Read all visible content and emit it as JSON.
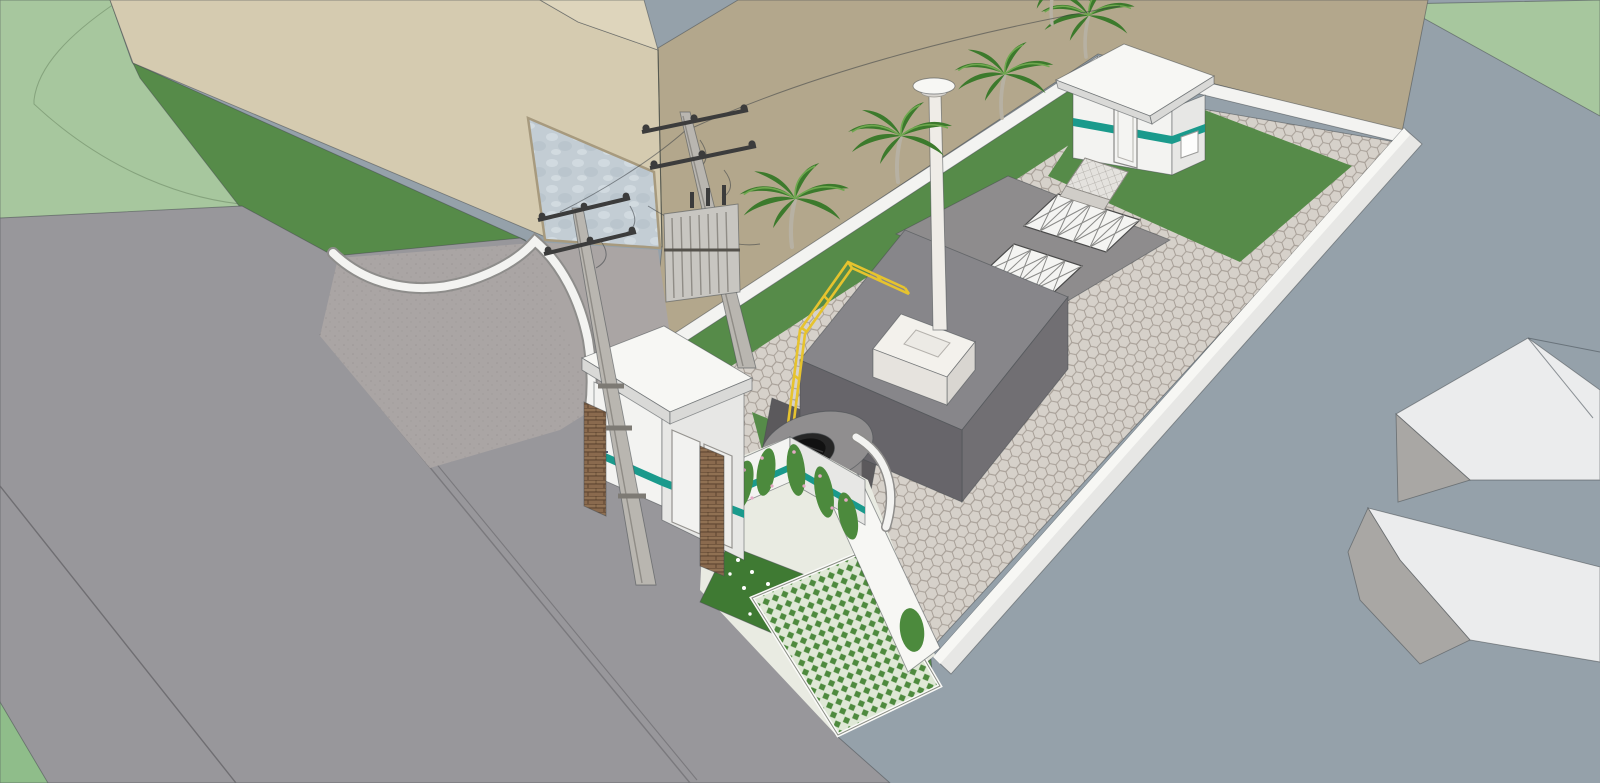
{
  "scene": {
    "viewport": "3d-site-model-viewport",
    "model": "utility-compound-site-plan",
    "objects": [
      "main-road",
      "entrance-forecourt",
      "large-beige-building",
      "building-window",
      "curved-entrance-wall",
      "gatehouse",
      "gatehouse-logo",
      "utility-pole-with-transformer",
      "utility-pole",
      "overhead-wires",
      "perimeter-wall",
      "palm-trees",
      "lawn",
      "hexagonal-paver-yard",
      "process-tank-building",
      "vent-chimney",
      "yellow-railing",
      "sunken-stair-pit",
      "grating-covers",
      "control-building",
      "walkway-ramp",
      "circular-pad-with-tank",
      "garden-courtyard",
      "climbing-vines",
      "flower-bed",
      "turf-block-driveway",
      "neighbor-building-masses",
      "street-area"
    ]
  },
  "colors": {
    "bluegray_street": "#95a1aa",
    "pale_green_field": "#a7c79e",
    "pale_green_dark": "#8fbd8a",
    "lawn_green": "#568b49",
    "lawn_green_dark": "#3f7a33",
    "tan_lot": "#b3a78c",
    "beige_wall": "#d5cbb0",
    "beige_roof_sliver": "#ded5bc",
    "window_glass": "#c3cdd4",
    "road_gray": "#98979b",
    "forecourt_gray": "#aaa5a4",
    "white_wall": "#f3f3f1",
    "white_wall_dim": "#e7e7e5",
    "white_wall_bright": "#f7f7f4",
    "wall_shade": "#d9d9d7",
    "hex_paver_bg": "#d6d1ca",
    "hex_paver_joint": "#a79f97",
    "slab_gray": "#8e8c8d",
    "tank_top": "#87868a",
    "tank_side_se": "#716f73",
    "tank_side_sw": "#67656a",
    "pit_dark": "#5b595c",
    "step_gray": "#9b999c",
    "pedestal_top": "#f3f1ec",
    "pedestal_side": "#d9d6d1",
    "pedestal_side2": "#e6e3de",
    "chimney_white": "#efece7",
    "yellow_rail": "#e6c32e",
    "teal_stripe": "#1a9a8c",
    "logo_blue": "#2b4fa0",
    "brick_brown": "#8a6a4e",
    "brick_line": "#5c4430",
    "pole_gray": "#b9b6b0",
    "pole_dark": "#8f8c86",
    "hardware_dark": "#3c3c3c",
    "transformer_gray": "#c8c6c1",
    "palm_dark": "#3c7a2c",
    "palm_light": "#6fa84f",
    "palm_trunk": "#b7b1a3",
    "black_tank": "#262626",
    "pad_gray": "#908e8f",
    "turf_base": "#dfe8d6",
    "turf_green": "#4e8a3e",
    "vine_green": "#4c8a3d",
    "vine_pink": "#e5a8c4",
    "flower_white": "#ffffff",
    "neighbor_white": "#ebeced",
    "neighbor_gray": "#a9a7a4",
    "walkway_paver": "#e4e2de"
  }
}
